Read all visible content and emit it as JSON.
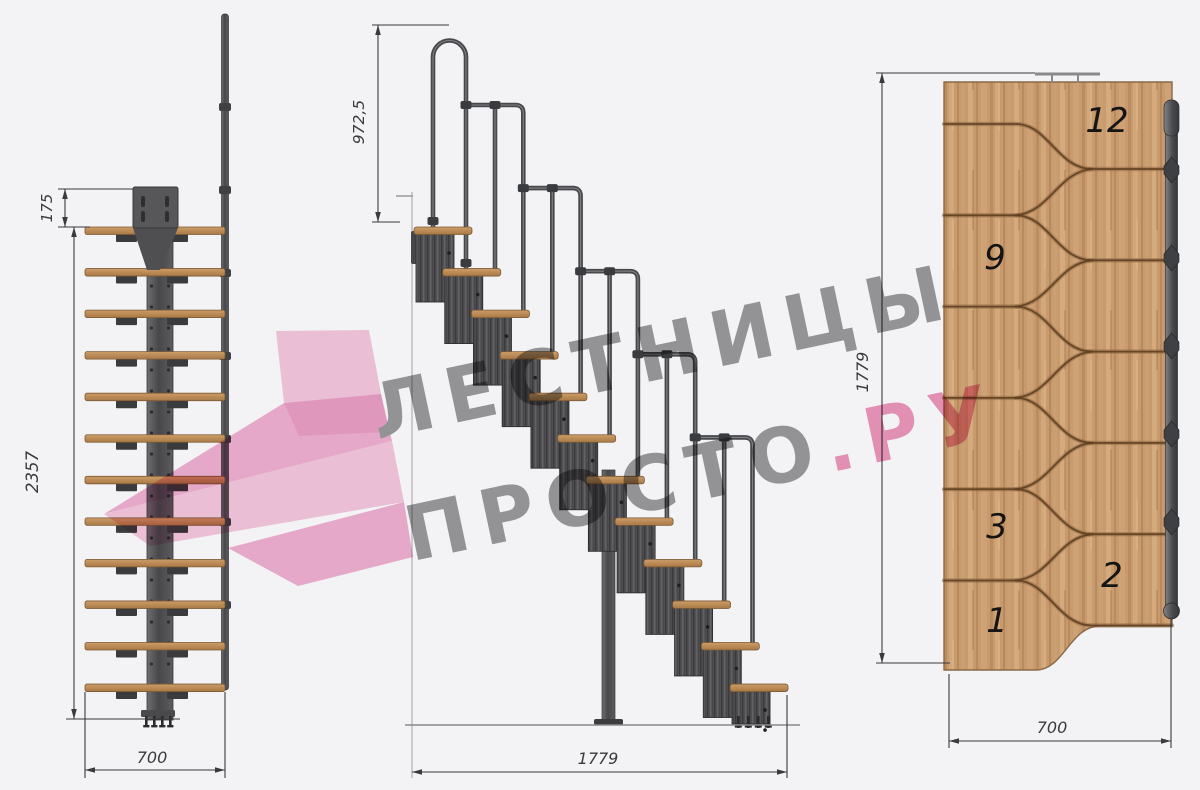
{
  "watermark": {
    "line1": "ЛЕСТНИЦЫ",
    "line2_gray": "ПРОСТО",
    "line2_pink": ".РУ"
  },
  "front_view": {
    "steps": 12,
    "dim_plate_offset": "175",
    "dim_total_height": "2357",
    "dim_width": "700"
  },
  "side_view": {
    "steps": 12,
    "rail_sections": 5,
    "dim_rail_height": "972,5",
    "dim_total_run": "1779"
  },
  "plan_view": {
    "steps": 12,
    "dim_total_run": "1779",
    "dim_width": "700",
    "step_numbers": [
      "12",
      "9",
      "3",
      "2",
      "1"
    ]
  },
  "colors": {
    "background": "#f3f3f5",
    "tread_light": "#cd9d68",
    "tread_dark": "#a97a46",
    "tread_edge": "#7c5a33",
    "wood_plan_base": "#c79b6e",
    "seam": "#5f3f20",
    "seam_soft": "#8a6440",
    "metal_base": "#515154",
    "metal_dark": "#2f2f31",
    "rail_tube": "#47484c",
    "rail_sheen": "#8e9092",
    "plate": "#57575a",
    "dimension": "#3a3a3a",
    "floor": "#8a8a8a",
    "wall": "#b0b0b2",
    "number": "#141414",
    "logo_light": "#f6c8de",
    "logo_mid": "#f1b0d0",
    "logo_deep": "#eaa0c4"
  }
}
